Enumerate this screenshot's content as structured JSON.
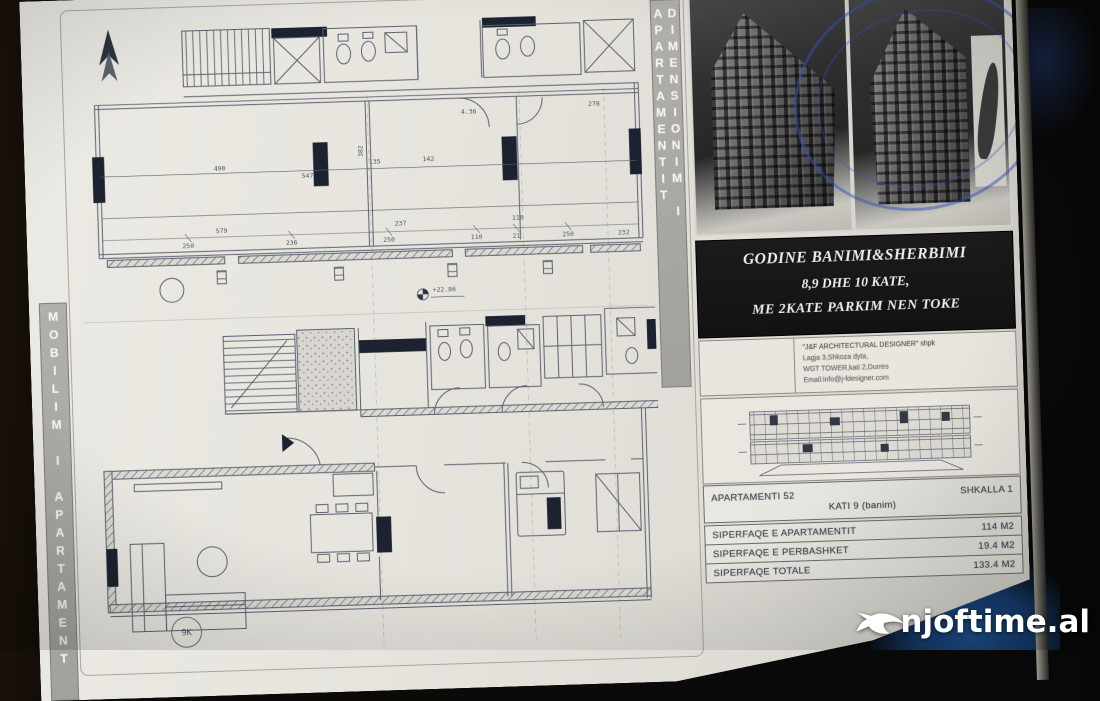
{
  "photo": {
    "background_color": "#0b0a09",
    "paper_color": "#e6e4dd",
    "stamp_color": "#3454be",
    "watermark": {
      "text": "njoftime.al"
    }
  },
  "strips": {
    "left_label": "MOBILIM I APARTAMENT",
    "right_label": "DIMENSIONIM I APARTAMENTIT"
  },
  "plans": {
    "level_marker": "+22.86",
    "sheet_circle_label": "9K",
    "dims_top": [
      "490",
      "547",
      "135",
      "142",
      "4.36",
      "278"
    ],
    "dims_mid": [
      "579",
      "237",
      "110",
      "382"
    ],
    "dims_bottom": [
      "250",
      "236",
      "250",
      "110",
      "21",
      "250",
      "232"
    ]
  },
  "banner": {
    "line1": "GODINE BANIMI&SHERBIMI",
    "line2": "8,9 DHE 10 KATE,",
    "line3": "ME 2KATE PARKIM NEN TOKE"
  },
  "architect_block": {
    "line1": "\"J&F ARCHITECTURAL DESIGNER\" shpk",
    "line2": "Lagja 3,Shkoza dyta,",
    "line3": "WGT TOWER,kati 2,Durres",
    "line4": "Email:info@j-fdesigner.com"
  },
  "info_table": {
    "rows": [
      {
        "label": "APARTAMENTI 52",
        "value": "SHKALLA 1"
      },
      {
        "label": "KATI 9 (banim)",
        "value": ""
      },
      {
        "label": "SIPERFAQE E APARTAMENTIT",
        "value": "114 M2"
      },
      {
        "label": "SIPERFAQE E PERBASHKET",
        "value": "19.4 M2"
      },
      {
        "label": "SIPERFAQE TOTALE",
        "value": "133.4 M2"
      }
    ]
  }
}
